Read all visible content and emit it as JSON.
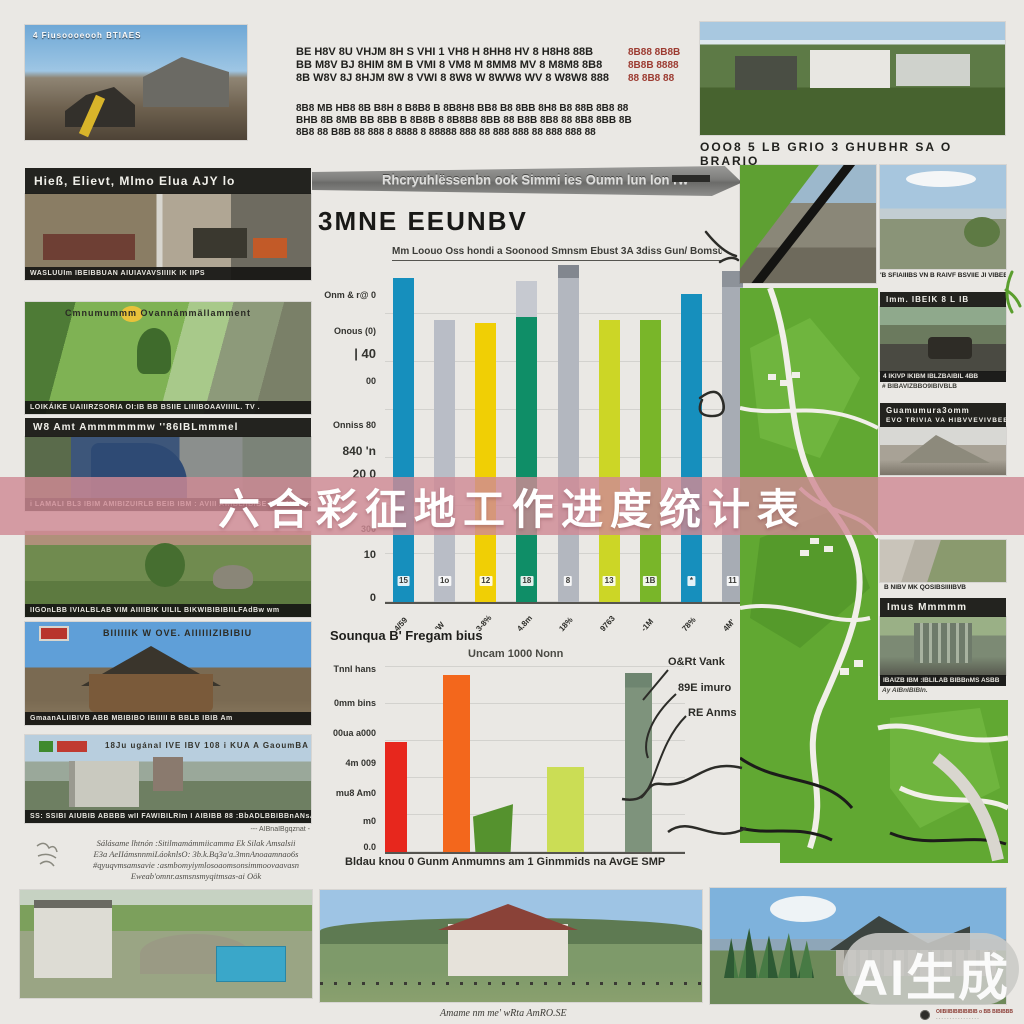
{
  "banner": {
    "title": "六合彩征地工作进度统计表",
    "bg": "#cf8a95",
    "text_color": "#ffffff"
  },
  "watermark": {
    "label": "AI生成"
  },
  "top": {
    "left_caption": "4 Fiusoooeooh  BTIAES",
    "row1_l1": "BE H8V 8U VHJM 8H S VHI 1 VH8 H 8HH8 HV 8 H8H8 88B",
    "row1_l2": "BB M8V BJ 8HIM 8M B VMI 8 VM8 M 8MM8 MV 8 M8M8 8B8",
    "row1_l3": "8B W8V 8J 8HJM 8W 8 VWI 8 8W8 W 8WW8 WV 8 W8W8 888",
    "row1_red": "8B88 8B8B\n8B8B 8888\n88 8B8 88",
    "row2_l1": "8B8 MB HB8 8B B8H 8 B8B8 B 8B8H8 BB8 B8 8BB 8H8 B8 88B 8B8 88",
    "row2_l2": "BHB 8B 8MB BB 8BB B 8B8B 8 8B8B8 8BB 88 B8B 8B8 88 8B8 8BB 8B",
    "row2_l3": "8B8 88 B8B 88 888 8 8888 8 88888 888 88 888 888 88 888 888 88",
    "right_caption": "OOO8  5 LB GRIO  3 GHUBHR SA  O BRARIO"
  },
  "left": {
    "b1_header": "Hieß, Elievt, Mlmo Elua AJY  lo",
    "b1_caption": "WASLUUIm  IBEIBBUAN AIUIAVAVSIIIIK IK IIPS",
    "b2_top": "Cmnumummm      Ovannámmällamment",
    "b2_caption": "LOIKÁIKE UAIIIRZSORIA OI:IB BB BSIIE LIIIIBOAAVIIIIL. TV .",
    "b3_header": "W8 Amt Ammmmmmw   ''86IBLmmmel",
    "b3_caption": "i  LAMALI BL3   IBIM AMIBIZUIRLB BEIB IBM :   AVIII   AwIBL/IBIBE IBM MIIBMIS  W",
    "b4_caption": "IIGOnLBB IVIALBLAB VIM AIIIIBIK  UILIL  BIKWIBIBIBIILFAdBw wm",
    "b5_title": "BIIIIIIK  W OVE. AIIIIIIZIBIBIU",
    "b5_caption": "GmaanALIIBIVB ABB MBIBIBO IBIIIII B BBLB IBIB Am",
    "b6_title": "18Ju ugánal IVE IBV 108 i KUA A GaoumBA m",
    "b6_caption": "SS: SSIBI AIUBIB ABBBB   wII FAWIBILRIm     I AIBIBB 88 :BbADLBBIBBnANsAsoa AvaIBaz",
    "b6_sub": "---  AIBnaIBgqznat  -",
    "paragraph": "Sálásame lhtnón  :Sitilmamámmiicamma Ek  Silak  Amsalsii\nE3a AeIIámsnnmiLáoknlsO: 3b.k.Bq3a'a.3mnAnoaamnao6s\n#qyuqvmsamsavie :asmbomyiymlosoaomsonsimmoovaavasn\nEweab'omnr.asmsnsmyqitmsas-ai Oök"
  },
  "center": {
    "strip": "Rhcryuhlëssenbn  ook Simmi ies Oumn lun  lon rw"
  },
  "right": {
    "r2_caption": "'B SFIAIIIBS VN B RAIVF BSVIIE  JI VIBEBIW",
    "r3_header": "Imm.  IBEIK 8 L IB",
    "r3_cap1": "4 IKIVP    IKIBM    IBLZBAIBIL 4BB",
    "r3_cap2": "# BIBAVIZBBO9IBIVBLB",
    "r4_h1": "Guamumura3omm",
    "r4_h2": "EVO TRIVIA VA HIBVVEVIVBEB BZLEEIBZB",
    "r5_caption": "B NIBV MK QOSIBSIIIIBVB",
    "r6_header": "Imus  Mmmmm",
    "r6_cap1": "IBAIZB IBM :IBLILAB BIBBnMS ASBB",
    "r6_cap2": "Ay  AIBnIBIBIn."
  },
  "bottom": {
    "mid_caption": "Amame nm me'  wRta AmRO.SE",
    "right_line1": "OIIBIIBIBIBIBIBIB o BB BIBIBBB",
    "right_line2": "- - - - - - - - - - - - - - - -"
  },
  "chart_data": [
    {
      "type": "bar",
      "title": "3MNE EEUNBV",
      "subtitle": "Mm Loouo Oss hondi a Soonood Smnsm Ebust 3A 3diss   Gun/ Bomsunnnig",
      "categories": [
        "4/59",
        "'W",
        "3-8%",
        "4.8m",
        "18%",
        "9763",
        "-1M",
        "78%",
        "4M'"
      ],
      "values": [
        100,
        87,
        86,
        88,
        100,
        87,
        87,
        95,
        97
      ],
      "bar_labels": [
        "15",
        "1o",
        "12",
        "18",
        "8",
        "13",
        "1B",
        "*",
        "11"
      ],
      "colors": [
        "#168fbd",
        "#b9bdc6",
        "#f0cf05",
        "#0f8e67",
        "#b3b7bf",
        "#ccd626",
        "#79b629",
        "#168fbd",
        "#a7acb4"
      ],
      "overlays": [
        {
          "i": 3,
          "from": 88,
          "to": 99,
          "color": "#c6c9d0"
        },
        {
          "i": 4,
          "from": 96,
          "to": 100,
          "color": "#82878f"
        },
        {
          "i": 8,
          "from": 92,
          "to": 97,
          "color": "#8d9299"
        }
      ],
      "ylabels": [
        "Onm & r@ 0",
        "Onous (0)",
        "| 40",
        "00",
        "Onniss 80",
        "840 'n",
        "20  0",
        "300",
        "10",
        "0"
      ],
      "ylim": [
        0,
        103
      ],
      "grid": true,
      "xlabel": "",
      "ylabel": ""
    },
    {
      "type": "bar",
      "title": "Sounqua B' Fregam bius",
      "subtitle": "Uncam 1000 Nonn",
      "categories": [
        "",
        "",
        "",
        "",
        ""
      ],
      "values": [
        62,
        100,
        27,
        48,
        101
      ],
      "colors": [
        "#e7271d",
        "#f3671c",
        "#55922e",
        "#cbdd55",
        "#7e937c"
      ],
      "ylabels": [
        "Tnnl hans",
        "0mm bins",
        "00ua a000",
        "4m 009",
        "mu8 Am0",
        "m0",
        "0.0"
      ],
      "legend": [
        "O&Rt  Vank",
        "89E  imuro",
        "RE  Anms"
      ],
      "xcaption": "Bldau knou 0  Gunm   Anmumns am 1  Ginmmids  na AvGE  SMP",
      "ylim": [
        0,
        105
      ],
      "grid": true
    }
  ]
}
